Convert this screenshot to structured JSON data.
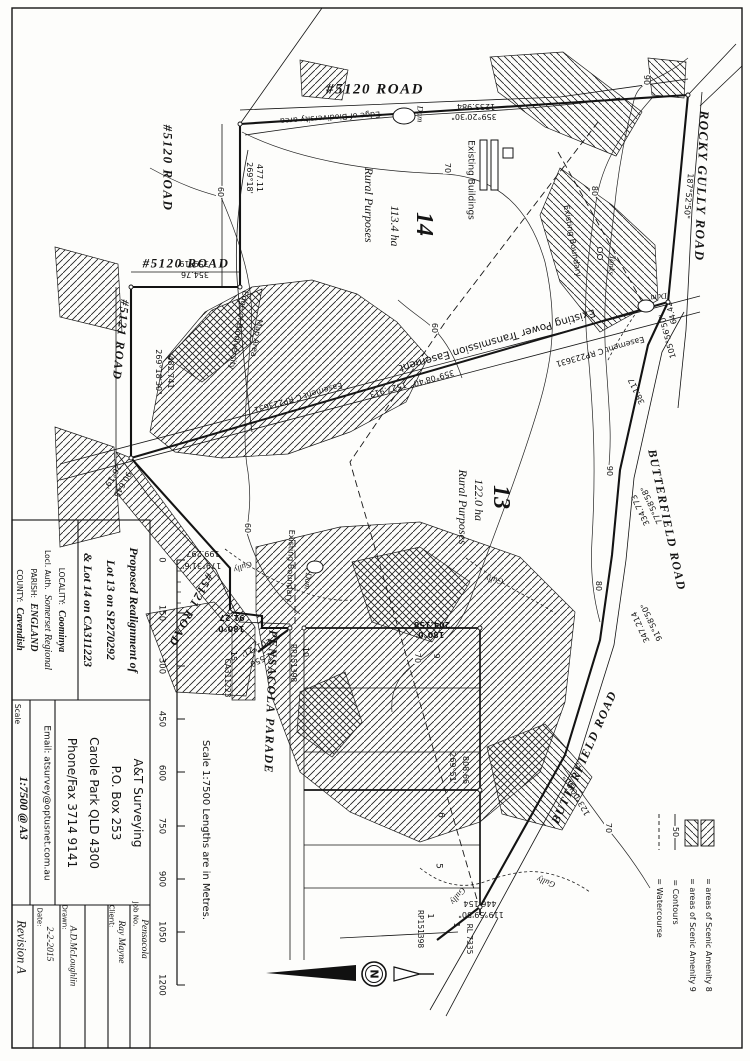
{
  "title_block": {
    "title_lines": [
      "Proposed Realignment of",
      "Lot 13 on SP270292",
      "& Lot 14 on CA311223"
    ],
    "locality_label": "LOCALITY:",
    "locality": "Coominya",
    "local_auth_label": "Locl. Auth.",
    "local_auth": "Somerset Regional",
    "parish_label": "PARISH:",
    "parish": "ENGLAND",
    "county_label": "COUNTY:",
    "county": "Cavendish",
    "firm_lines": [
      "A&T Surveying",
      "P.O. Box 253",
      "Carole Park QLD 4300",
      "Phone/Fax 3714 9141"
    ],
    "email": "Email: atsurvey@optusnet.com.au",
    "scale_label": "Scale",
    "scale_value": "1:7500 @ A3",
    "revision": "Revision A",
    "date_label": "Date:",
    "date": "2-2-2015",
    "drawn_label": "Drawn:",
    "drawn": "A.D.McLoughlin",
    "client_label": "Client:",
    "client": "Ray Mayne",
    "job_label": "Job No.",
    "job": "Pensacola"
  },
  "scale_bar": {
    "ticks": [
      "0",
      "150",
      "300",
      "450",
      "600",
      "750",
      "900",
      "1050",
      "1200"
    ],
    "caption": "Scale 1:7500  Lengths are in Metres."
  },
  "legend": {
    "items": [
      {
        "symbol": "hatch-amenity-8-swatch",
        "text": "= areas of Scenic Amenity 8"
      },
      {
        "symbol": "hatch-amenity-9-swatch",
        "text": "= areas of Scenic Amenity 9"
      },
      {
        "symbol": "contour-line-symbol",
        "text": "= Contours"
      },
      {
        "symbol": "watercourse-dashed-symbol",
        "text": "= Watercourse"
      }
    ]
  },
  "map": {
    "labels": [
      {
        "t": "#5120 ROAD",
        "x": 375,
        "y": 90,
        "r": 0,
        "c": "rd",
        "f": 15
      },
      {
        "t": "#5120 ROAD",
        "x": 168,
        "y": 168,
        "r": 90,
        "c": "rd",
        "f": 13
      },
      {
        "t": "#5120 ROAD",
        "x": 186,
        "y": 263,
        "r": 0,
        "c": "rd",
        "f": 13
      },
      {
        "t": "#5121 ROAD",
        "x": 121,
        "y": 340,
        "r": 96,
        "c": "rd",
        "f": 12
      },
      {
        "t": "#5121 ROAD",
        "x": 191,
        "y": 610,
        "r": 118,
        "c": "rd",
        "f": 12
      },
      {
        "t": "ROCKY GULLY ROAD",
        "x": 702,
        "y": 186,
        "r": 92,
        "c": "rd",
        "f": 13
      },
      {
        "t": "BUTTERFIELD ROAD",
        "x": 667,
        "y": 520,
        "r": 78,
        "c": "rd",
        "f": 12
      },
      {
        "t": "BUTTERFIELD ROAD",
        "x": 584,
        "y": 757,
        "r": 294,
        "c": "rd",
        "f": 12
      },
      {
        "t": "PENSACOLA PARADE",
        "x": 271,
        "y": 702,
        "r": 92,
        "c": "rd",
        "f": 12
      },
      {
        "t": "14",
        "x": 424,
        "y": 224,
        "r": 90,
        "c": "bg",
        "f": 24
      },
      {
        "t": "113.4 ha",
        "x": 395,
        "y": 226,
        "r": 90,
        "c": "ar",
        "f": 12
      },
      {
        "t": "Rural Purposes",
        "x": 369,
        "y": 205,
        "r": 90,
        "c": "ar",
        "f": 12
      },
      {
        "t": "13",
        "x": 501,
        "y": 497,
        "r": 90,
        "c": "bg",
        "f": 24
      },
      {
        "t": "122.0 ha",
        "x": 479,
        "y": 500,
        "r": 90,
        "c": "ar",
        "f": 12
      },
      {
        "t": "Rural Purposes",
        "x": 463,
        "y": 507,
        "r": 90,
        "c": "ar",
        "f": 12
      },
      {
        "t": "Existing Power Transmission Easement",
        "x": 497,
        "y": 340,
        "r": 164,
        "c": "an",
        "f": 10.5
      },
      {
        "t": "Easement C RP223631",
        "x": 298,
        "y": 397,
        "r": 164,
        "c": "nm"
      },
      {
        "t": "Easement C RP223631",
        "x": 600,
        "y": 351,
        "r": 164,
        "c": "nm"
      },
      {
        "t": "1527.913",
        "x": 388,
        "y": 389,
        "r": 164,
        "c": "nm"
      },
      {
        "t": "359°08'40\"",
        "x": 432,
        "y": 378,
        "r": 164,
        "c": "nm"
      },
      {
        "t": "477.11",
        "x": 259,
        "y": 178,
        "r": 90,
        "c": "nm"
      },
      {
        "t": "269°18'",
        "x": 249,
        "y": 178,
        "r": 90,
        "c": "nm"
      },
      {
        "t": "359°19'",
        "x": 193,
        "y": 263,
        "r": 180,
        "c": "nm"
      },
      {
        "t": "354.76",
        "x": 195,
        "y": 274,
        "r": 180,
        "c": "nm"
      },
      {
        "t": "1233.984",
        "x": 476,
        "y": 106,
        "r": 180,
        "c": "nm"
      },
      {
        "t": "359°20'30\"",
        "x": 474,
        "y": 116,
        "r": 180,
        "c": "nm"
      },
      {
        "t": "482.741",
        "x": 170,
        "y": 372,
        "r": 90,
        "c": "nm"
      },
      {
        "t": "269°18'30\"",
        "x": 158,
        "y": 372,
        "r": 90,
        "c": "nm"
      },
      {
        "t": "26°19'",
        "x": 112,
        "y": 476,
        "r": 120,
        "c": "nm"
      },
      {
        "t": "90.645",
        "x": 122,
        "y": 484,
        "r": 120,
        "c": "nm"
      },
      {
        "t": "199.297",
        "x": 203,
        "y": 553,
        "r": 180,
        "c": "nm"
      },
      {
        "t": "179°31'6\"",
        "x": 201,
        "y": 565,
        "r": 180,
        "c": "nm"
      },
      {
        "t": "91.27",
        "x": 232,
        "y": 617,
        "r": 180,
        "c": "nm",
        "b": 1
      },
      {
        "t": "180°0'",
        "x": 230,
        "y": 628,
        "r": 180,
        "c": "nm",
        "b": 1
      },
      {
        "t": "201°21'",
        "x": 256,
        "y": 647,
        "r": 155,
        "c": "nm"
      },
      {
        "t": "21.550",
        "x": 263,
        "y": 658,
        "r": 155,
        "c": "nm"
      },
      {
        "t": "204.158",
        "x": 432,
        "y": 624,
        "r": 180,
        "c": "nm",
        "b": 1
      },
      {
        "t": "180°0'",
        "x": 430,
        "y": 634,
        "r": 180,
        "c": "nm",
        "b": 1
      },
      {
        "t": "269°51'",
        "x": 452,
        "y": 768,
        "r": 90,
        "c": "nm"
      },
      {
        "t": "808.66",
        "x": 465,
        "y": 770,
        "r": 90,
        "c": "nm"
      },
      {
        "t": "38.117",
        "x": 637,
        "y": 391,
        "r": 245,
        "c": "nm"
      },
      {
        "t": "77°58'58\"",
        "x": 652,
        "y": 505,
        "r": 245,
        "c": "nm"
      },
      {
        "t": "334.773",
        "x": 641,
        "y": 510,
        "r": 245,
        "c": "nm"
      },
      {
        "t": "91°58'50\"",
        "x": 652,
        "y": 622,
        "r": 245,
        "c": "nm"
      },
      {
        "t": "347.214",
        "x": 641,
        "y": 627,
        "r": 245,
        "c": "nm"
      },
      {
        "t": "105°56'50\"",
        "x": 668,
        "y": 336,
        "r": 255,
        "c": "nm"
      },
      {
        "t": "64.42",
        "x": 672,
        "y": 313,
        "r": 255,
        "c": "nm"
      },
      {
        "t": "187°52'50\"",
        "x": 688,
        "y": 196,
        "r": 95,
        "c": "nm"
      },
      {
        "t": "123°00'50\"",
        "x": 577,
        "y": 795,
        "r": 240,
        "c": "nm"
      },
      {
        "t": "119°59'50\"",
        "x": 481,
        "y": 914,
        "r": 180,
        "c": "nm"
      },
      {
        "t": "446.154",
        "x": 480,
        "y": 903,
        "r": 180,
        "c": "nm"
      },
      {
        "t": "15",
        "x": 233,
        "y": 656,
        "r": 90,
        "c": "nm"
      },
      {
        "t": "CA311223",
        "x": 227,
        "y": 678,
        "r": 90,
        "c": "nm",
        "f": 7.5
      },
      {
        "t": "10",
        "x": 305,
        "y": 652,
        "r": 90,
        "c": "nm"
      },
      {
        "t": "RP151398",
        "x": 293,
        "y": 663,
        "r": 90,
        "c": "nm",
        "f": 7.5
      },
      {
        "t": "9",
        "x": 436,
        "y": 656,
        "r": 90,
        "c": "nm"
      },
      {
        "t": "6",
        "x": 440,
        "y": 815,
        "r": 90,
        "c": "nm",
        "f": 9
      },
      {
        "t": "5",
        "x": 438,
        "y": 866,
        "r": 90,
        "c": "nm",
        "f": 9
      },
      {
        "t": "1",
        "x": 430,
        "y": 916,
        "r": 90,
        "c": "nm"
      },
      {
        "t": "RP151398",
        "x": 420,
        "y": 929,
        "r": 90,
        "c": "nm",
        "f": 7.5
      },
      {
        "t": "1",
        "x": 456,
        "y": 925,
        "r": 90,
        "c": "nm"
      },
      {
        "t": "RL 7335",
        "x": 469,
        "y": 939,
        "r": 90,
        "c": "nm",
        "f": 7.5
      },
      {
        "t": "Edge of Biodiversity area",
        "x": 330,
        "y": 117,
        "r": 176,
        "c": "nm"
      },
      {
        "t": "Edge of Biodiversity",
        "x": 238,
        "y": 330,
        "r": 100,
        "c": "nm"
      },
      {
        "t": "Map Area",
        "x": 256,
        "y": 338,
        "r": 100,
        "c": "nm"
      },
      {
        "t": "Existing Buildings",
        "x": 470,
        "y": 180,
        "r": 90,
        "c": "an",
        "f": 9
      },
      {
        "t": "Existing Boundary",
        "x": 572,
        "y": 241,
        "r": 80,
        "c": "nm"
      },
      {
        "t": "Existing Boundary",
        "x": 290,
        "y": 566,
        "r": 92,
        "c": "nm"
      },
      {
        "t": "Dam",
        "x": 420,
        "y": 114,
        "r": 90,
        "c": "it"
      },
      {
        "t": "Dam",
        "x": 659,
        "y": 297,
        "r": 170,
        "c": "it"
      },
      {
        "t": "Dam",
        "x": 308,
        "y": 581,
        "r": 95,
        "c": "it"
      },
      {
        "t": "Tanks",
        "x": 612,
        "y": 265,
        "r": 95,
        "c": "it"
      },
      {
        "t": "Gully",
        "x": 243,
        "y": 567,
        "r": 160,
        "c": "it"
      },
      {
        "t": "Gully",
        "x": 494,
        "y": 580,
        "r": 190,
        "c": "it"
      },
      {
        "t": "Gully",
        "x": 546,
        "y": 882,
        "r": 200,
        "c": "it"
      },
      {
        "t": "Gully",
        "x": 458,
        "y": 896,
        "r": 130,
        "c": "it"
      },
      {
        "t": "90",
        "x": 646,
        "y": 80,
        "r": 90,
        "c": "cn"
      },
      {
        "t": "80",
        "x": 594,
        "y": 191,
        "r": 90,
        "c": "cn"
      },
      {
        "t": "70",
        "x": 447,
        "y": 168,
        "r": 90,
        "c": "cn"
      },
      {
        "t": "60",
        "x": 220,
        "y": 192,
        "r": 90,
        "c": "cn"
      },
      {
        "t": "60",
        "x": 434,
        "y": 328,
        "r": 90,
        "c": "cn"
      },
      {
        "t": "90",
        "x": 609,
        "y": 471,
        "r": 90,
        "c": "cn"
      },
      {
        "t": "80",
        "x": 598,
        "y": 586,
        "r": 90,
        "c": "cn"
      },
      {
        "t": "70",
        "x": 417,
        "y": 658,
        "r": 90,
        "c": "cn"
      },
      {
        "t": "70",
        "x": 608,
        "y": 828,
        "r": 90,
        "c": "cn"
      },
      {
        "t": "60",
        "x": 247,
        "y": 528,
        "r": 90,
        "c": "cn"
      },
      {
        "t": "50",
        "x": 675,
        "y": 832,
        "r": 90,
        "c": "cn"
      },
      {
        "t": "N",
        "x": 374,
        "y": 974,
        "r": 90,
        "c": "an",
        "f": 11,
        "b": 1
      }
    ]
  }
}
